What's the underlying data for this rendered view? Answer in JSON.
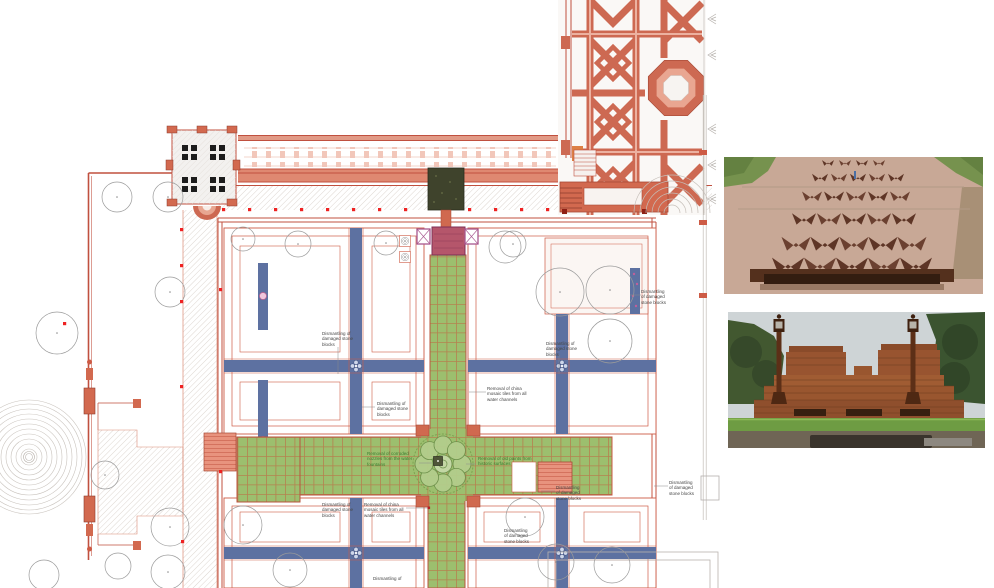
{
  "plan": {
    "annotations": [
      {
        "text": "Dismantling of damaged stone blocks",
        "tone": "dark"
      },
      {
        "text": "Dismantling of damaged stone blocks",
        "tone": "dark"
      },
      {
        "text": "Dismantling of damaged stone blocks",
        "tone": "dark"
      },
      {
        "text": "Dismantling of damaged stone blocks",
        "tone": "dark"
      },
      {
        "text": "Removal of china mosaic tiles from all water channels",
        "tone": "dark"
      },
      {
        "text": "Removal of corroded nozzles from the water fountains",
        "tone": "green"
      },
      {
        "text": "Removal of old paints from historic surfaces",
        "tone": "green"
      },
      {
        "text": "Dismantling of damaged stone blocks",
        "tone": "dark"
      },
      {
        "text": "Removal of china mosaic tiles from all water channels",
        "tone": "dark"
      },
      {
        "text": "Dismantling of damaged stone blocks",
        "tone": "dark"
      },
      {
        "text": "Dismantling of damaged stone blocks",
        "tone": "dark"
      },
      {
        "text": "Dismantling of damaged stone blocks",
        "tone": "dark"
      },
      {
        "text": "Dismantling of",
        "tone": "dark"
      }
    ],
    "colors": {
      "wall_red": "#c0503f",
      "path_fill": "#df8871",
      "pale_pink": "#f2c7ba",
      "lawn_green": "#9cbf6e",
      "grid_line": "#c2603f",
      "channel_blue": "#5d71a1",
      "accent_magenta": "#a8578f",
      "tree_outline": "#9a9a9a",
      "survey_dot": "#ee2222",
      "note_green": "#3a7d31",
      "note_gray": "#454545"
    }
  },
  "photos": {
    "top": {
      "name": "carved-sandstone-water-chute-photo"
    },
    "bottom": {
      "name": "red-sandstone-terrace-with-lamps-photo"
    }
  }
}
